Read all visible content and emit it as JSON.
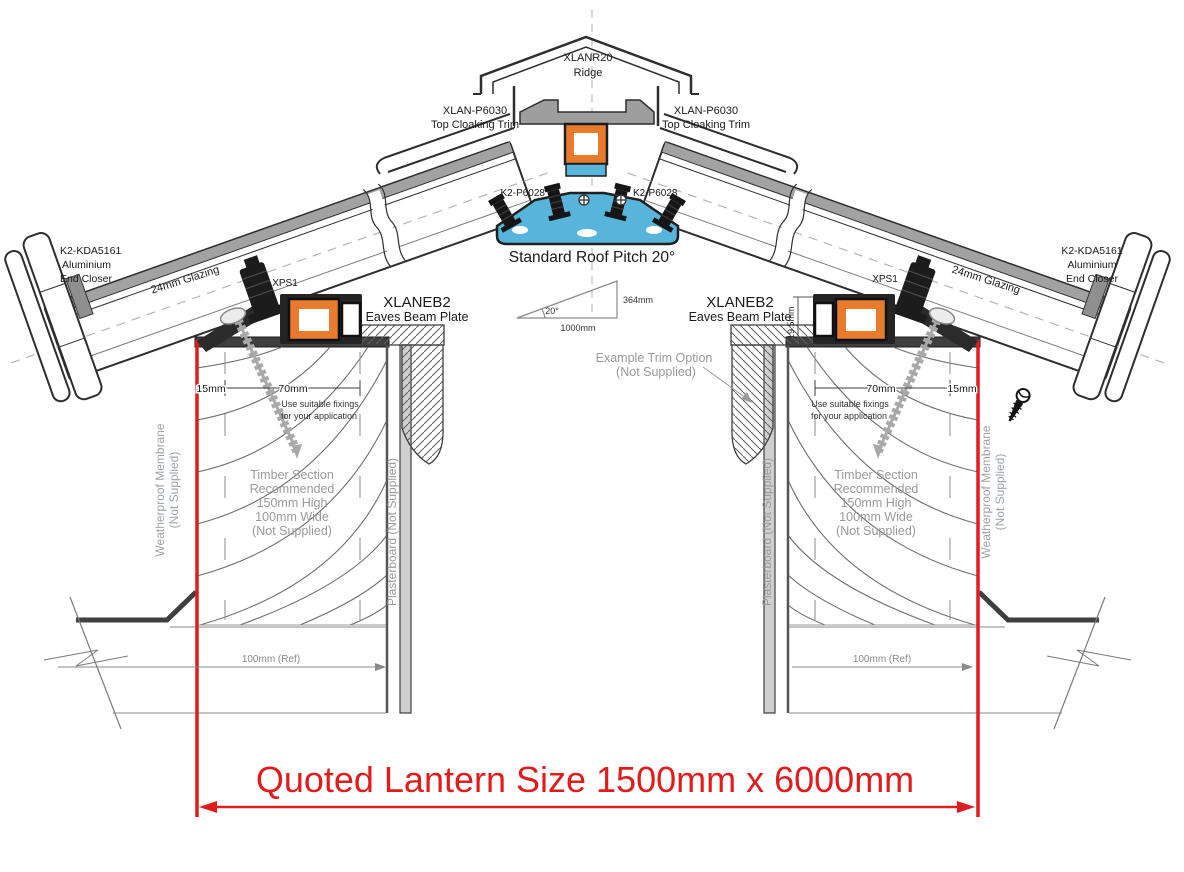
{
  "drawing": {
    "ridge": {
      "code": "XLANR20",
      "label": "Ridge"
    },
    "cloaking_left": {
      "code": "XLAN-P6030",
      "label": "Top Cloaking Trim"
    },
    "cloaking_right": {
      "code": "XLAN-P6030",
      "label": "Top Cloaking Trim"
    },
    "ridge_bolt_left": {
      "code": "K2-P6028"
    },
    "ridge_bolt_right": {
      "code": "K2-P6028"
    },
    "pitch": {
      "title": "Standard Roof Pitch 20°",
      "angle": "20°",
      "base": "1000mm",
      "rise": "364mm"
    },
    "glazing_left": "24mm Glazing",
    "glazing_right": "24mm Glazing",
    "end_closer_left": [
      "K2-KDA5161",
      "Aluminium",
      "End Closer"
    ],
    "end_closer_right": [
      "K2-KDA5161",
      "Aluminium",
      "End Closer"
    ],
    "eaves_left": {
      "code": "XLANEB2",
      "label": "Eaves Beam Plate",
      "clamp": "XPS1"
    },
    "eaves_right": {
      "code": "XLANEB2",
      "label": "Eaves Beam Plate",
      "clamp": "XPS1",
      "upstand": "19.5mm"
    },
    "kerb_left": {
      "dim_edge": "15mm",
      "dim_center": "70mm",
      "fix1": "Use suitable fixings",
      "fix2": "for your application",
      "timber": [
        "Timber Section",
        "Recommended",
        "150mm High",
        "100mm Wide",
        "(Not Supplied)"
      ],
      "plasterboard": "Plasterboard (Not Supplied)",
      "membrane1": "Weatherproof Membrane",
      "membrane2": "(Not Supplied)",
      "ref": "100mm (Ref)"
    },
    "kerb_right": {
      "dim_edge": "15mm",
      "dim_center": "70mm",
      "fix1": "Use suitable fixings",
      "fix2": "for your application",
      "timber": [
        "Timber Section",
        "Recommended",
        "150mm High",
        "100mm Wide",
        "(Not Supplied)"
      ],
      "plasterboard": "Plasterboard (Not Supplied)",
      "membrane1": "Weatherproof Membrane",
      "membrane2": "(Not Supplied)",
      "ref": "100mm (Ref)"
    },
    "trim_note": [
      "Example  Trim Option",
      "(Not Supplied)"
    ],
    "quote": "Quoted Lantern Size 1500mm x 6000mm",
    "colors": {
      "accent_red": "#e01c1c",
      "profile_orange": "#e87b2e",
      "profile_blue": "#57b5dc",
      "metal_gray": "#9e9e9e",
      "annotation_gray": "#9a9a9a",
      "line_dark": "#2e2e2e"
    }
  }
}
